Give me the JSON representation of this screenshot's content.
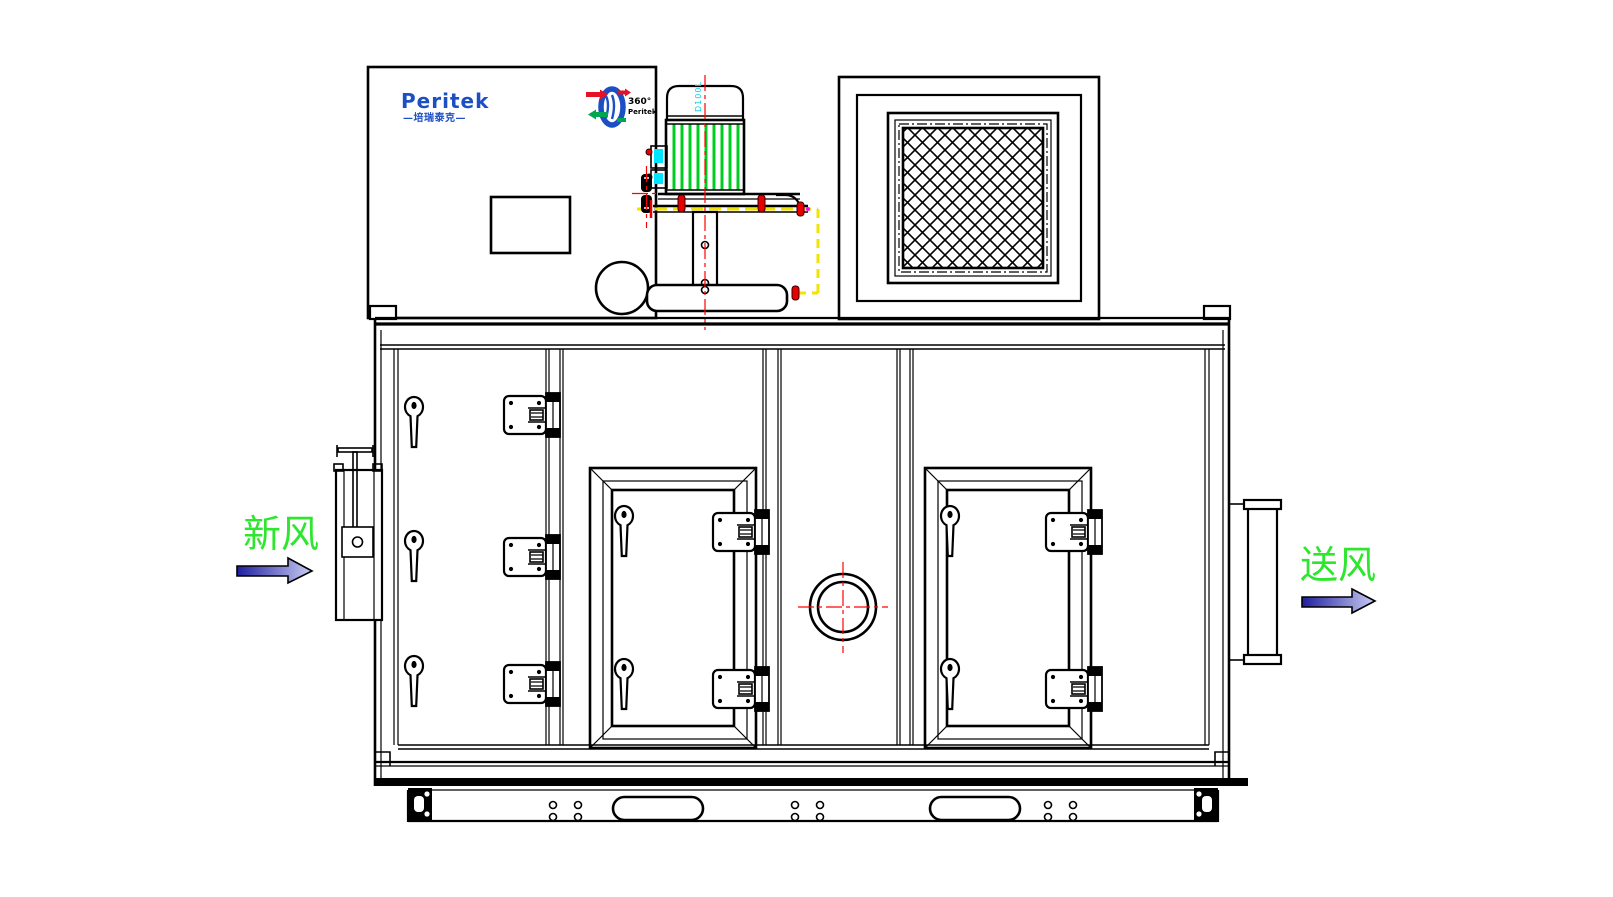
{
  "drawing": {
    "title": "Peritek rotary dehumidifier unit - front elevation",
    "labels": {
      "fresh_air": "新风",
      "supply_air": "送风"
    },
    "logo": {
      "brand": "Peritek",
      "sub_brand": "—培瑞泰克—"
    },
    "rotor_logo": {
      "degree_text": "360°",
      "brand_text": "Peritek"
    },
    "motor": {
      "model_label": "D100L"
    },
    "colors": {
      "line": "#000000",
      "centerline_red": "#ff0000",
      "bolt_red": "#e60000",
      "datum_yellow": "#f2e300",
      "fin_green": "#00cc22",
      "label_green": "#2ee62e",
      "logo_blue": "#1d4fc4",
      "terminal_cyan": "#00e5ff",
      "magenta_marker": "#ff00ff",
      "arrow_gradient_start": "#1f1f9e",
      "arrow_gradient_end": "#c9ccf4"
    }
  }
}
